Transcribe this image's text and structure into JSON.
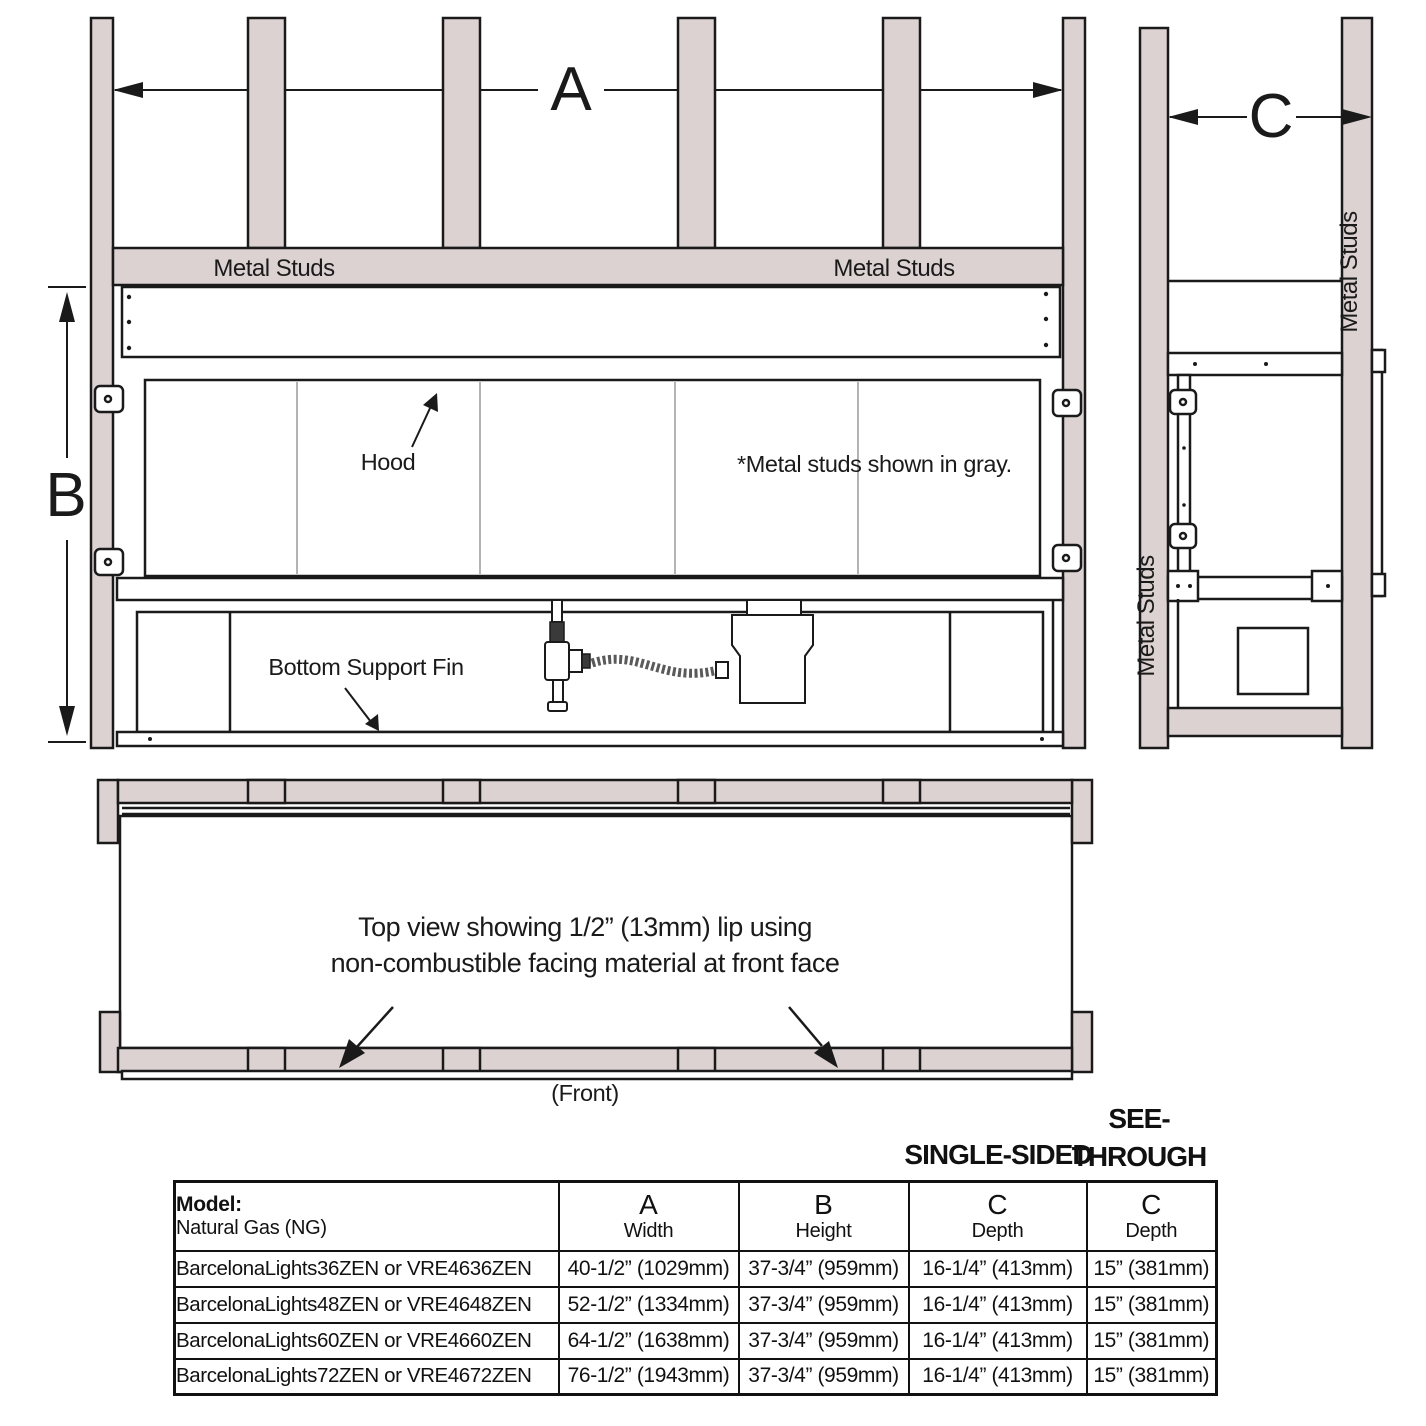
{
  "colors": {
    "stud_fill": "#DCD2D2",
    "outline": "#1A1A1A"
  },
  "front_view": {
    "dim_a_label": "A",
    "dim_b_label": "B",
    "metal_studs_left_label": "Metal Studs",
    "metal_studs_right_label": "Metal Studs",
    "hood_label": "Hood",
    "gray_note": "*Metal studs shown in gray.",
    "bottom_support_fin_label": "Bottom Support Fin"
  },
  "side_view": {
    "dim_c_label": "C",
    "metal_studs_left_label": "Metal Studs",
    "metal_studs_right_label": "Metal Studs"
  },
  "top_view": {
    "caption_line1": "Top view showing 1/2” (13mm) lip using",
    "caption_line2": "non-combustible facing material at front face",
    "front_label": "(Front)"
  },
  "table": {
    "single_sided_label": "SINGLE-SIDED",
    "see_through_line1": "SEE-",
    "see_through_line2": "THROUGH",
    "header": {
      "model_title": "Model:",
      "model_subtitle": "Natural Gas (NG)",
      "a_letter": "A",
      "a_label": "Width",
      "b_letter": "B",
      "b_label": "Height",
      "c1_letter": "C",
      "c1_label": "Depth",
      "c2_letter": "C",
      "c2_label": "Depth"
    },
    "rows": [
      {
        "model": "BarcelonaLights36ZEN or VRE4636ZEN",
        "width": "40-1/2” (1029mm)",
        "height": "37-3/4” (959mm)",
        "depth_single": "16-1/4” (413mm)",
        "depth_see_through": "15” (381mm)"
      },
      {
        "model": "BarcelonaLights48ZEN or VRE4648ZEN",
        "width": "52-1/2” (1334mm)",
        "height": "37-3/4” (959mm)",
        "depth_single": "16-1/4” (413mm)",
        "depth_see_through": "15” (381mm)"
      },
      {
        "model": "BarcelonaLights60ZEN or VRE4660ZEN",
        "width": "64-1/2” (1638mm)",
        "height": "37-3/4” (959mm)",
        "depth_single": "16-1/4” (413mm)",
        "depth_see_through": "15” (381mm)"
      },
      {
        "model": "BarcelonaLights72ZEN or VRE4672ZEN",
        "width": "76-1/2” (1943mm)",
        "height": "37-3/4” (959mm)",
        "depth_single": "16-1/4” (413mm)",
        "depth_see_through": "15” (381mm)"
      }
    ]
  }
}
